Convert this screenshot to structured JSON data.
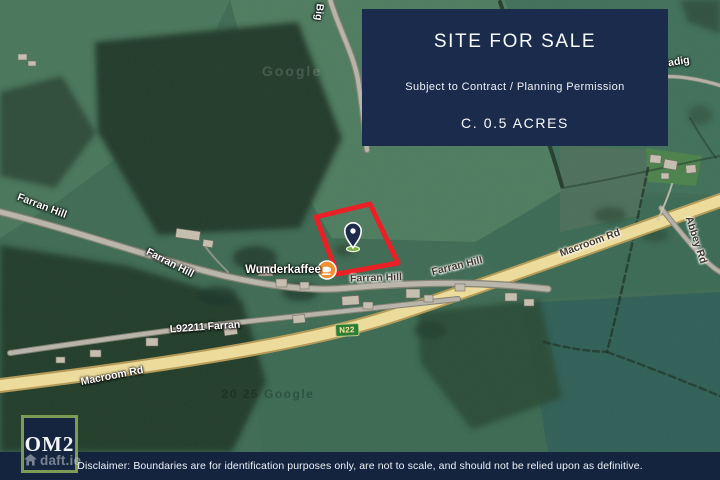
{
  "banner": {
    "title": "SITE FOR SALE",
    "subtitle": "Subject to Contract / Planning Permission",
    "size": "C. 0.5 ACRES"
  },
  "footer": {
    "disclaimer": "Disclaimer: Boundaries are for identification purposes only, are not to scale, and should not be relied upon as definitive."
  },
  "logo": {
    "label": "OM2"
  },
  "watermark": {
    "brand": "daft.ie",
    "icon": "house-icon"
  },
  "map": {
    "poi": {
      "label": "Wunderkaffee",
      "icon": "coffee-cup-icon"
    },
    "road_shield": {
      "label": "N22"
    },
    "marker": {
      "type": "location-pin"
    },
    "labels": [
      {
        "text": "Farran Hill",
        "x": 42,
        "y": 206,
        "rot": 21,
        "style": "light"
      },
      {
        "text": "Farran Hill",
        "x": 170,
        "y": 263,
        "rot": 27,
        "style": "light"
      },
      {
        "text": "Farran Hill",
        "x": 376,
        "y": 278,
        "rot": -2,
        "style": "dark"
      },
      {
        "text": "Farran Hill",
        "x": 457,
        "y": 266,
        "rot": -14,
        "style": "dark"
      },
      {
        "text": "Macroom Rd",
        "x": 590,
        "y": 243,
        "rot": -20,
        "style": "dark"
      },
      {
        "text": "Macroom Rd",
        "x": 112,
        "y": 376,
        "rot": -11,
        "style": "light"
      },
      {
        "text": "L92211 Farran",
        "x": 205,
        "y": 327,
        "rot": -4,
        "style": "light"
      },
      {
        "text": "Abbey Rd",
        "x": 696,
        "y": 240,
        "rot": 72,
        "style": "dark"
      },
      {
        "text": "eadig",
        "x": 676,
        "y": 62,
        "rot": -9,
        "style": "light"
      },
      {
        "text": "Big",
        "x": 319,
        "y": 12,
        "rot": 96,
        "style": "light"
      },
      {
        "text": "Google",
        "x": 292,
        "y": 71,
        "rot": 0,
        "style": "ghost"
      },
      {
        "text": "20 25 Google",
        "x": 268,
        "y": 394,
        "rot": 0,
        "style": "ghost-dark"
      }
    ]
  },
  "colors": {
    "banner_bg": "#1b2b4c",
    "footer_bg": "#14233e",
    "logo_border": "#7e9b55",
    "boundary_red": "#e92127",
    "poi_orange": "#ef9031",
    "pin_navy": "#1d2c4b",
    "pin_base_green": "#76b043",
    "shield_green": "#2e7d36",
    "main_road_yellow": "#eedd9b"
  }
}
